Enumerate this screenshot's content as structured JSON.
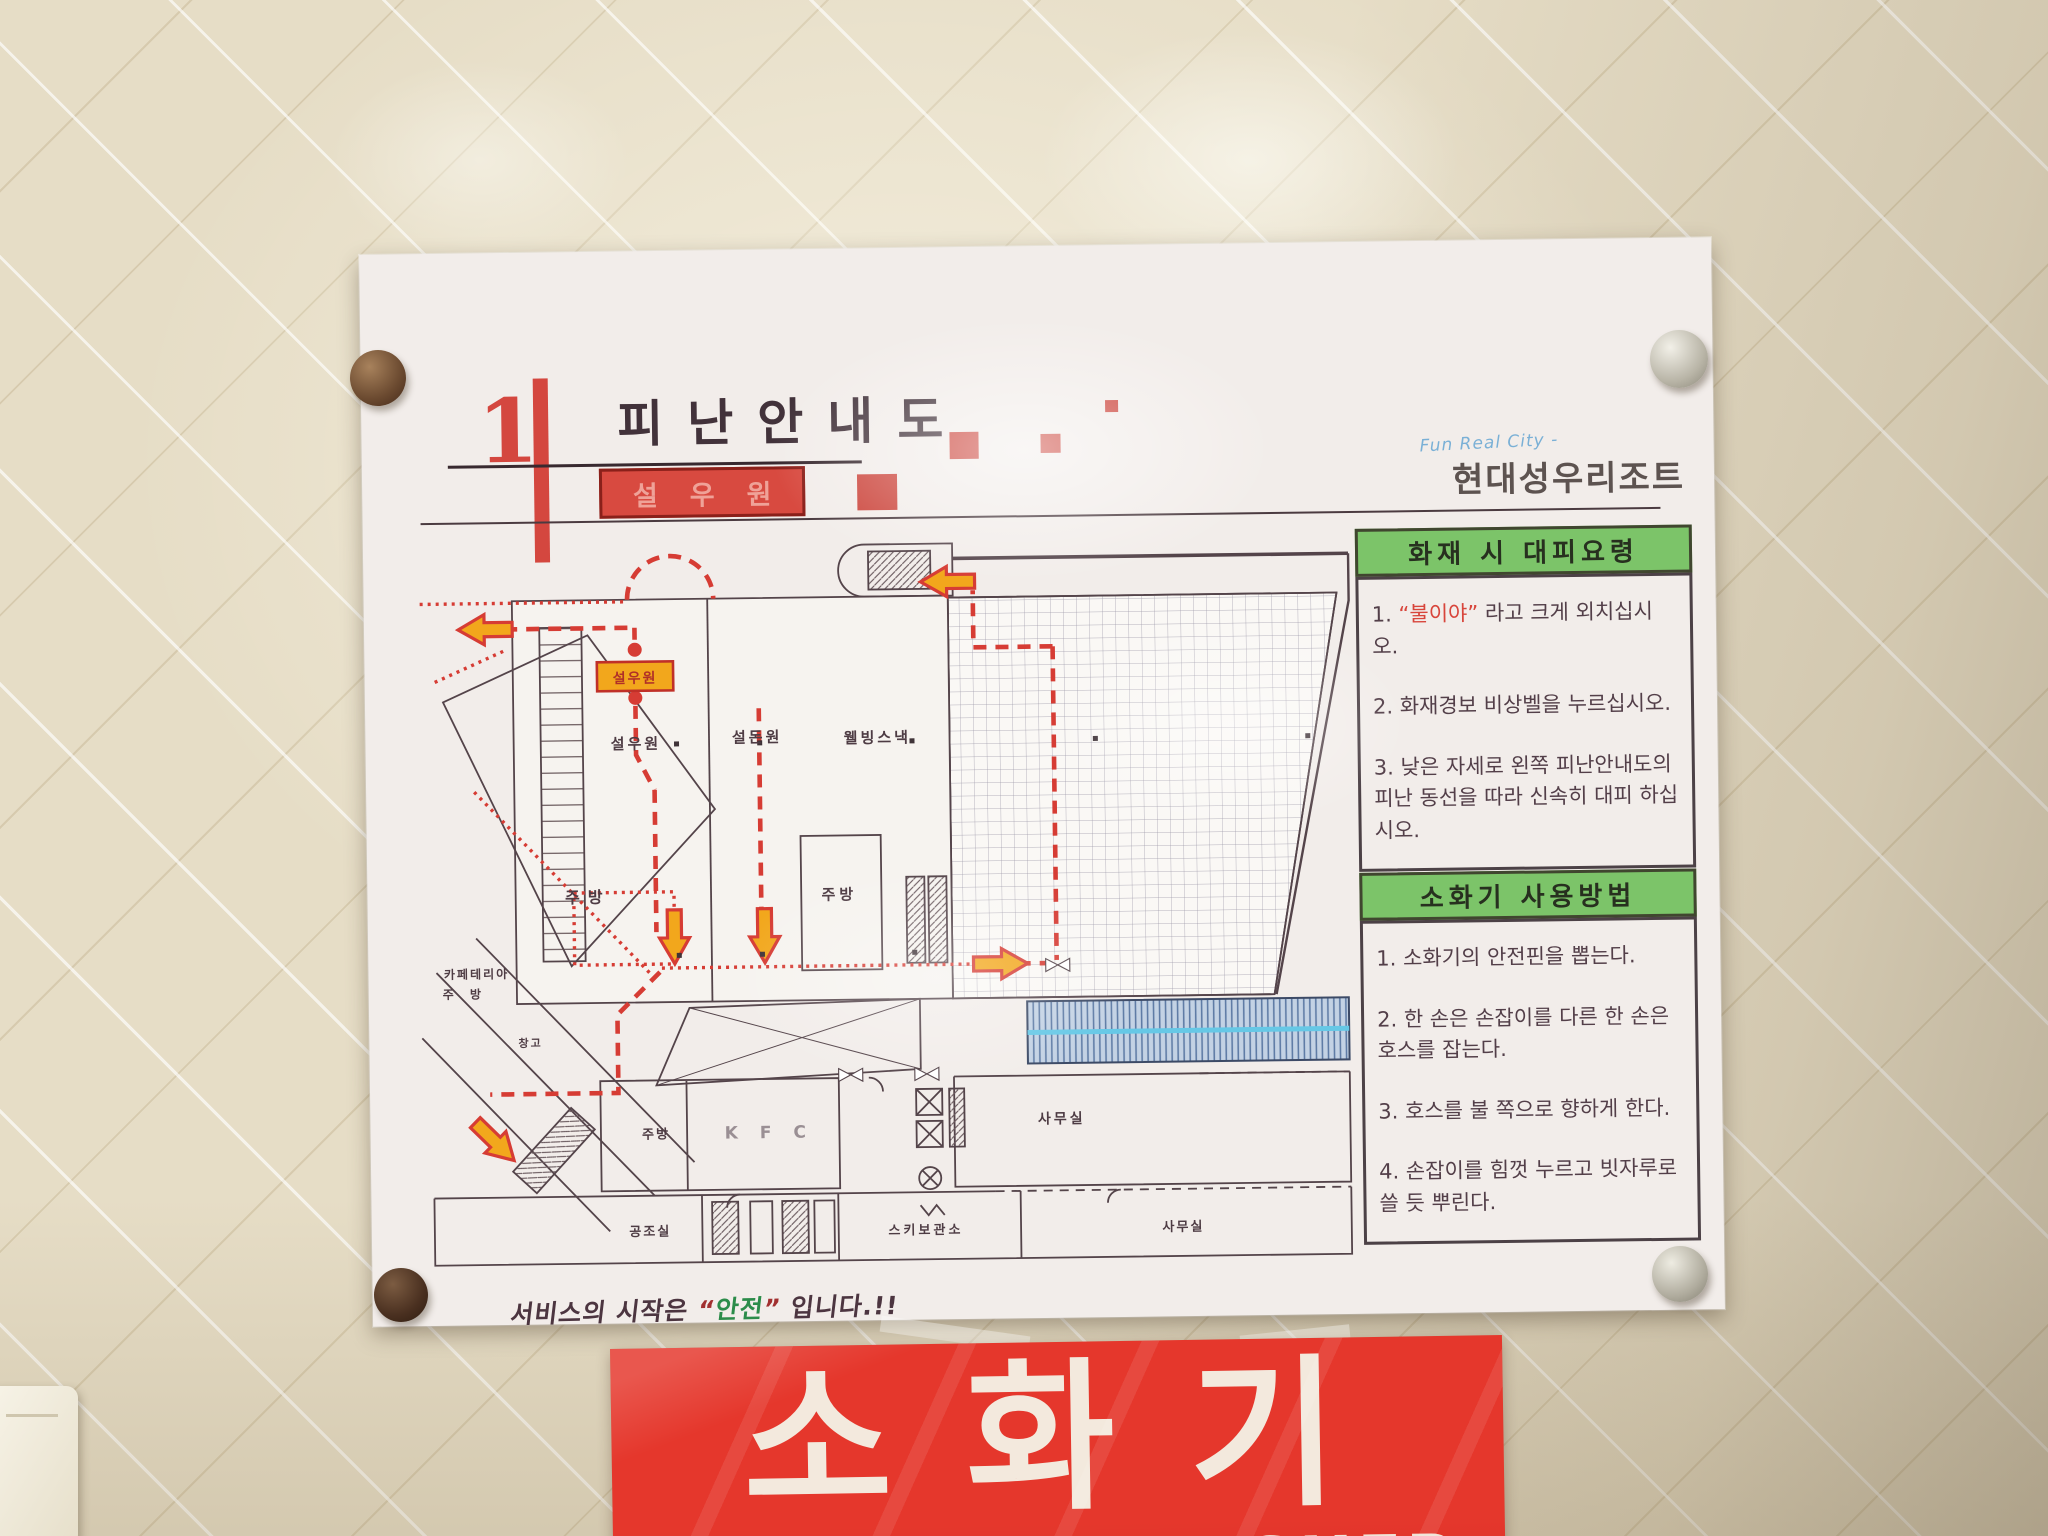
{
  "poster": {
    "floor_number": "1",
    "title": "피난안내도",
    "location_badge": "설우원",
    "logo": {
      "tagline": "Fun Real City -",
      "name": "현대성우리조트"
    },
    "panels": [
      {
        "header": "화재 시 대피요령",
        "item1_pre": "1. ",
        "item1_red": "“불이야”",
        "item1_rest": " 라고 크게 외치십시오.",
        "item2": "2. 화재경보 비상벨을 누르십시오.",
        "item3": "3. 낮은 자세로 왼쪽 피난안내도의 피난 동선을 따라 신속히 대피 하십시오."
      },
      {
        "header": "소화기 사용방법",
        "items": [
          "1. 소화기의 안전핀을 뽑는다.",
          "2. 한 손은 손잡이를 다른 한 손은 호스를 잡는다.",
          "3. 호스를 불 쪽으로 향하게 한다.",
          "4. 손잡이를 힘껏 누르고 빗자루로 쓸 듯 뿌린다."
        ]
      }
    ],
    "slogan": {
      "pre": "서비스의 시작은 ",
      "quote_open": "“",
      "highlight": "안전",
      "quote_close": "”",
      "post": " 입니다.!!"
    },
    "plan": {
      "badge": "설우원",
      "rooms": {
        "seolwoowon": "설우원",
        "seoldonwon": "설돈원",
        "wellbeing_snack": "웰빙스낵",
        "kitchen_a": "주방",
        "kitchen_b": "주방",
        "kitchen_c": "주방",
        "cafeteria_line1": "카페테리아",
        "cafeteria_line2": "주 방",
        "storage": "창고",
        "kfc": "K F C",
        "office_mid": "사무실",
        "hvac": "공조실",
        "ski_storage": "스키보관소",
        "office_bottom": "사무실"
      }
    }
  },
  "sign": {
    "korean": "소화기",
    "english": "FIRE EXTINGUISHER"
  },
  "colors": {
    "accent_red": "#d4473f",
    "route_red": "#d63c34",
    "panel_green": "#7cc469",
    "badge_yellow": "#f2a71c",
    "sign_red": "#e5372c",
    "walkway_blue": "#c3d2e4",
    "walkway_cyan": "#66c8e6"
  }
}
